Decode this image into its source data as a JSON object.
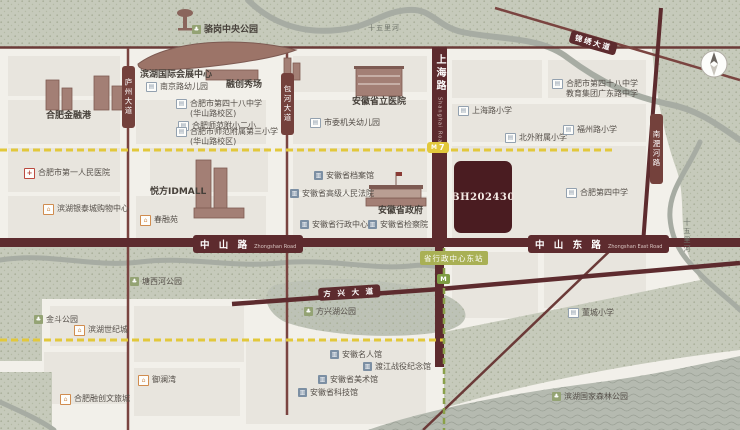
{
  "icons": {
    "school": "▤",
    "gov": "▥",
    "hospital": "+",
    "residence": "⌂",
    "park": "♣",
    "metro": "M"
  },
  "roads": {
    "shanghai_zh": "上海路",
    "shanghai_en": "Shanghai Road",
    "zhongshan_zh": "中 山 路",
    "zhongshan_en": "Zhongshan Road",
    "zhongshan_east_zh": "中 山 东 路",
    "zhongshan_east_en": "Zhongshan East Road",
    "luzhou": "庐州大道",
    "baohe": "包河大道",
    "nanfeihe": "南淝河路",
    "fangxing": "方 兴 大 道",
    "jinxiu": "锦绣大道"
  },
  "rivers": {
    "top": "十五里河",
    "right": "十五里河"
  },
  "metro": {
    "line7_num": "7",
    "station_east": "省行政中心东站"
  },
  "parcel": {
    "code": "BH202430"
  },
  "pois": {
    "luogang_park": "骆岗中央公园",
    "exhibition_center": "滨湖国际会展中心",
    "financial_port": "合肥金融港",
    "shifan_fuxiao2": "合肥师范附小二小",
    "nanjing_rd_kindergarten": "南京路幼儿园",
    "rongchuang": "融创秀场",
    "h48_huashan_l1": "合肥市第四十八中学",
    "h48_huashan_l2": "(华山路校区)",
    "shifan3_l1": "合肥市师范附属第三小学",
    "shifan3_l2": "(华山路校区)",
    "provincial_hospital": "安徽省立医院",
    "city_kindergarten": "市委机关幼儿园",
    "h48_guangdong_l1": "合肥市第四十八中学",
    "h48_guangdong_l2": "教育集团广东路中学",
    "shanghai_rd_primary": "上海路小学",
    "beiwai_primary": "北外附属小学",
    "fuzhou_rd_primary": "福州路小学",
    "no4_middle": "合肥第四中学",
    "first_peoples_hospital": "合肥市第一人民医院",
    "yuefang_idmall": "悦方IDMALL",
    "yintai_mall": "滨湖银泰城购物中心",
    "chunrongyuan": "春融苑",
    "archives": "安徽省档案馆",
    "high_court": "安徽省高级人民法院",
    "provincial_gov": "安徽省政府",
    "admin_center": "安徽省行政中心",
    "procuratorate": "安徽省检察院",
    "tangxihe_park": "塘西河公园",
    "jindou_park": "金斗公园",
    "binhu_century": "滨湖世纪城",
    "yulanwan": "御澜湾",
    "wenlvcheng": "合肥融创文旅城",
    "fangxinghu_park": "方兴湖公园",
    "celebrity_museum": "安徽名人馆",
    "dujiang_memorial": "渡江战役纪念馆",
    "art_museum": "安徽省美术馆",
    "science_museum": "安徽省科技馆",
    "dongcheng_primary": "董城小学",
    "forest_park": "滨湖国家森林公园"
  },
  "colors": {
    "road_main": "#5d2b2e",
    "parcel_block": "#4a1c21",
    "metro_line7": "#e2c83b",
    "metro_green": "#8aa04a",
    "park_green": "#c6cabb",
    "water_grey": "#b5bab0"
  }
}
